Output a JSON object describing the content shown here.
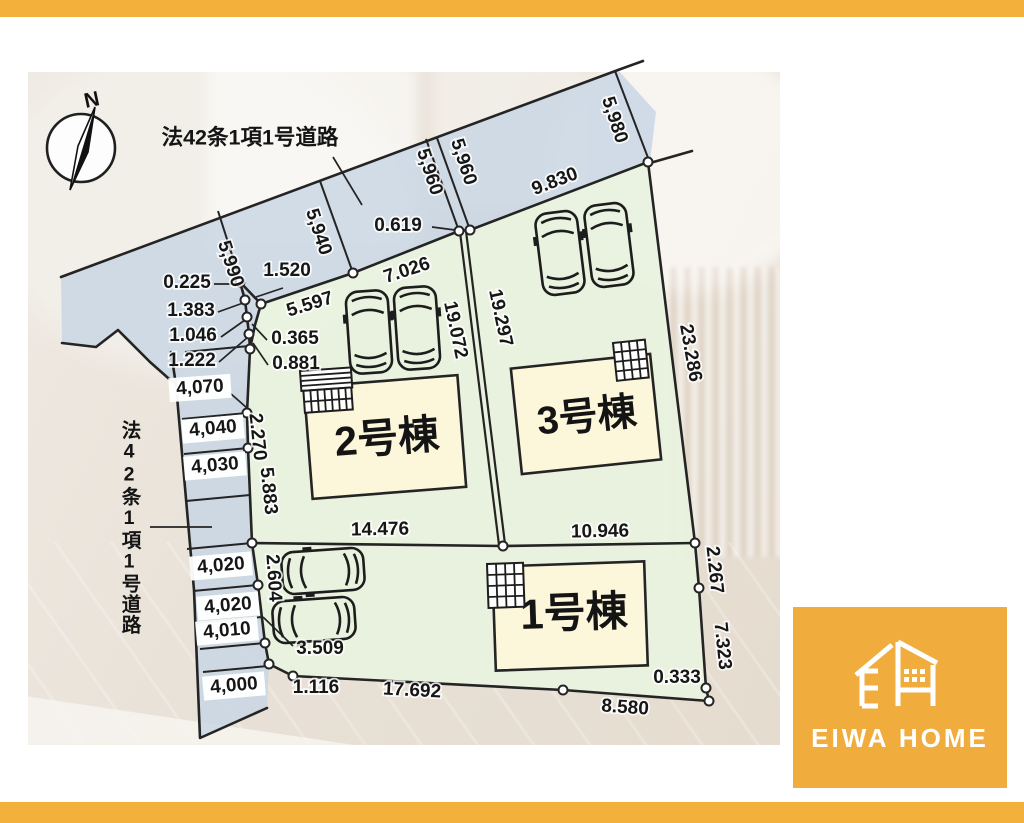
{
  "colors": {
    "accent": "#F3B13C",
    "logo_bg": "#F0AD3E",
    "road_fill": "#C8D5E4",
    "lot_fill": "#E9F2DF",
    "building_fill": "#FCF6DA",
    "line": "#242424"
  },
  "plan": {
    "compass_n": "N",
    "road_label_top": "法42条1項1号道路",
    "road_label_left": "法42条1項1号道路",
    "buildings": {
      "b1": "1号棟",
      "b2": "2号棟",
      "b3": "3号棟"
    },
    "dims": {
      "w5990": "5,990",
      "w5940": "5,940",
      "w5960a": "5,960",
      "w5960b": "5,960",
      "w5980": "5,980",
      "f1520": "1.520",
      "f0619": "0.619",
      "f5597": "5.597",
      "f7026": "7.026",
      "f9830": "9.830",
      "c0225": "0.225",
      "c1383": "1.383",
      "c1046": "1.046",
      "c1222": "1.222",
      "c0365": "0.365",
      "c0881": "0.881",
      "l4070": "4,070",
      "l4040": "4,040",
      "l4030": "4,030",
      "l4020a": "4,020",
      "l4020b": "4,020",
      "l4010": "4,010",
      "l4000": "4,000",
      "e2270": "2.270",
      "e5883": "5.883",
      "v19072": "19.072",
      "v19297": "19.297",
      "v23286": "23.286",
      "m14476": "14.476",
      "m10946": "10.946",
      "s2604": "2.604",
      "s3509": "3.509",
      "s1116": "1.116",
      "s17692": "17.692",
      "s8580": "8.580",
      "s0333": "0.333",
      "s2267": "2.267",
      "s7323": "7.323"
    }
  },
  "logo": {
    "brand": "EIWA HOME"
  }
}
